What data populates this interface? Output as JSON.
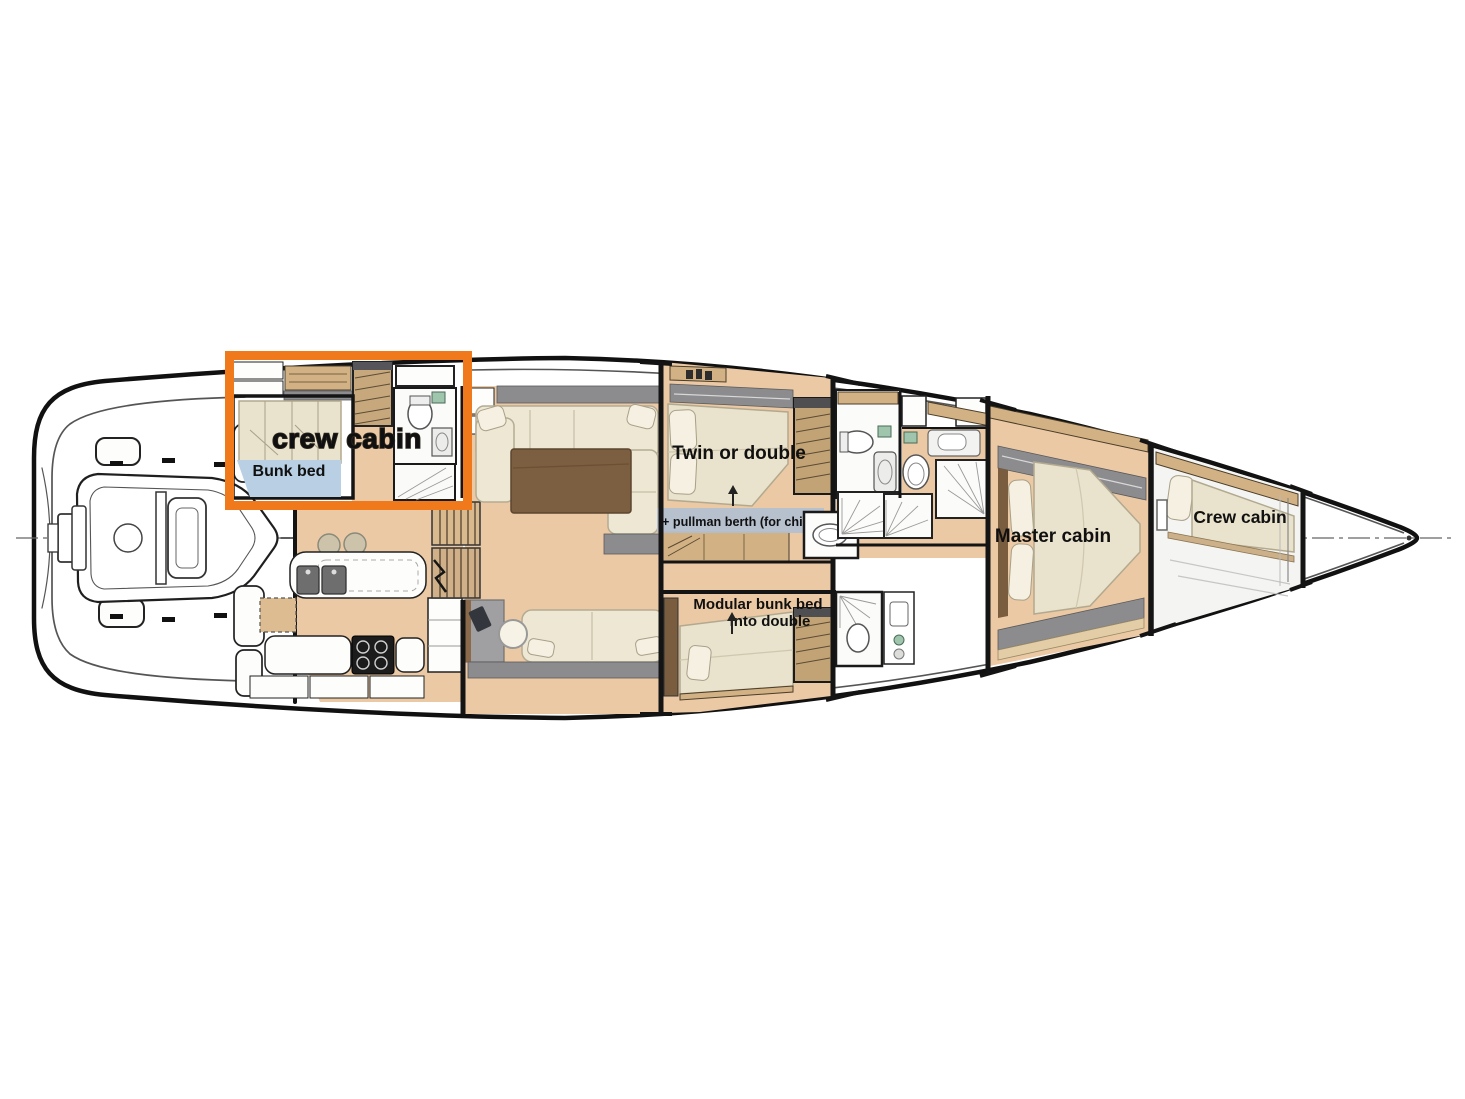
{
  "diagram": {
    "type": "sailing-yacht-interior-deck-plan",
    "orientation": "bow-right",
    "highlight_box": {
      "label": "crew cabin",
      "color": "#f0791c"
    },
    "labels": {
      "aft_crew_cabin": "crew cabin",
      "aft_crew_bunk": "Bunk bed",
      "guest_cabin": "Twin or double",
      "pullman_note": "+ pullman berth (for child)",
      "modular_cabin_line1": "Modular bunk bed",
      "modular_cabin_line2": "into double",
      "master_cabin": "Master cabin",
      "bow_crew_cabin": "Crew cabin"
    },
    "colors": {
      "highlight_orange": "#f0791c",
      "floor_wood": "#ecc9a5",
      "upholstery": "#e9e2cc",
      "joinery_wood": "#d2b284",
      "bunk_floor_blue": "#b8cfe4",
      "pullman_label_bg": "#b4c1d0",
      "hull_outline": "#111111"
    }
  }
}
